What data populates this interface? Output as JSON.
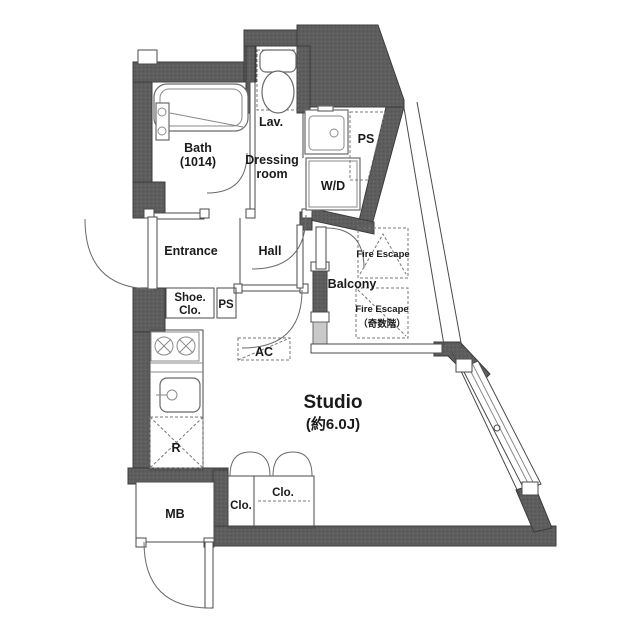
{
  "plan": {
    "title": "Studio apartment floor plan",
    "labels": {
      "bath": "Bath",
      "bath_size": "(1014)",
      "lavatory": "Lav.",
      "dressing_line1": "Dressing",
      "dressing_line2": "room",
      "ps_upper": "PS",
      "washer_dryer": "W/D",
      "entrance": "Entrance",
      "hall": "Hall",
      "shoe_closet_line1": "Shoe.",
      "shoe_closet_line2": "Clo.",
      "ps_lower": "PS",
      "ac": "AC",
      "balcony": "Balcony",
      "fire_escape_upper": "Fire Escape",
      "fire_escape_lower_line1": "Fire Escape",
      "fire_escape_lower_line2": "（奇数階）",
      "studio": "Studio",
      "studio_size": "(約6.0J)",
      "refrigerator": "R",
      "meter_box": "MB",
      "closet_small": "Clo.",
      "closet_large": "Clo."
    },
    "colors": {
      "wall": "#5d5d5d",
      "wall_dot": "#6e6e6e",
      "line": "#4a4a4a",
      "background": "#ffffff"
    }
  }
}
